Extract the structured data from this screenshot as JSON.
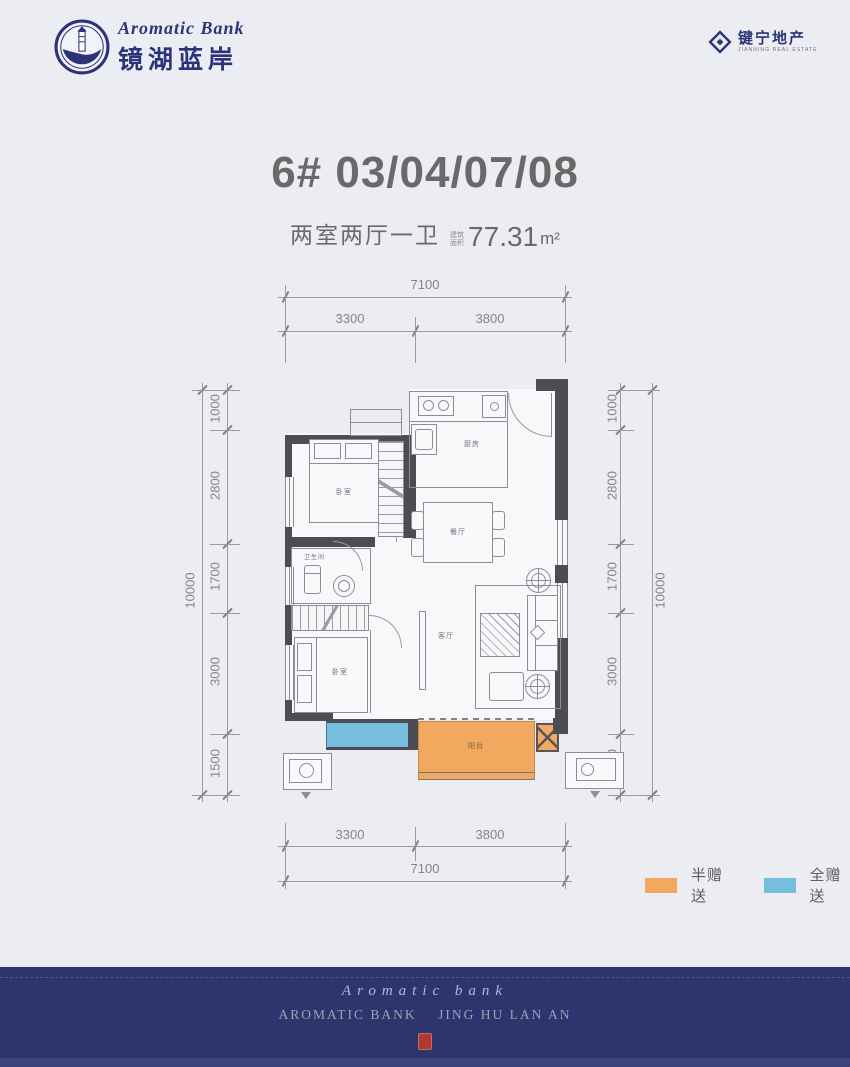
{
  "page": {
    "bg": "#ecedf3"
  },
  "header": {
    "brand": {
      "script": "Aromatic Bank",
      "name_cn": "镜湖蓝岸"
    },
    "developer": {
      "name_cn": "键宁地产",
      "name_en": "JIANNING REAL ESTATE"
    }
  },
  "title": "6# 03/04/07/08",
  "subtitle": {
    "layout": "两室两厅一卫",
    "area_label": "建筑面积",
    "area_value": "77.31",
    "area_unit": "m²"
  },
  "floorplan": {
    "rooms": {
      "bedroom_top": "卧室",
      "kitchen": "厨房",
      "dining": "餐厅",
      "bathroom": "卫生间",
      "bedroom_bottom": "卧室",
      "living": "客厅",
      "balcony": "阳台"
    },
    "dims": {
      "top": {
        "total": "7100",
        "segments": [
          "3300",
          "3800"
        ]
      },
      "bottom": {
        "total": "7100",
        "segments": [
          "3300",
          "3800"
        ]
      },
      "left": {
        "total": "10000",
        "segments": [
          "1000",
          "2800",
          "1700",
          "3000",
          "1500"
        ]
      },
      "right": {
        "total": "10000",
        "segments": [
          "1000",
          "2800",
          "1700",
          "3000",
          "1500"
        ]
      }
    },
    "colors": {
      "wall": "#4c4c55",
      "line": "#8d8d96",
      "half_gift": "#f1a95f",
      "full_gift": "#75bedd"
    }
  },
  "legend": {
    "items": [
      {
        "label": "半赠送",
        "color": "#f1a95f"
      },
      {
        "label": "全赠送",
        "color": "#75bedd"
      }
    ]
  },
  "footer": {
    "script": "Aromatic bank",
    "caps": "AROMATIC BANK    JING HU LAN AN",
    "bg": "#2d356f",
    "seal_color": "#b03a30"
  }
}
